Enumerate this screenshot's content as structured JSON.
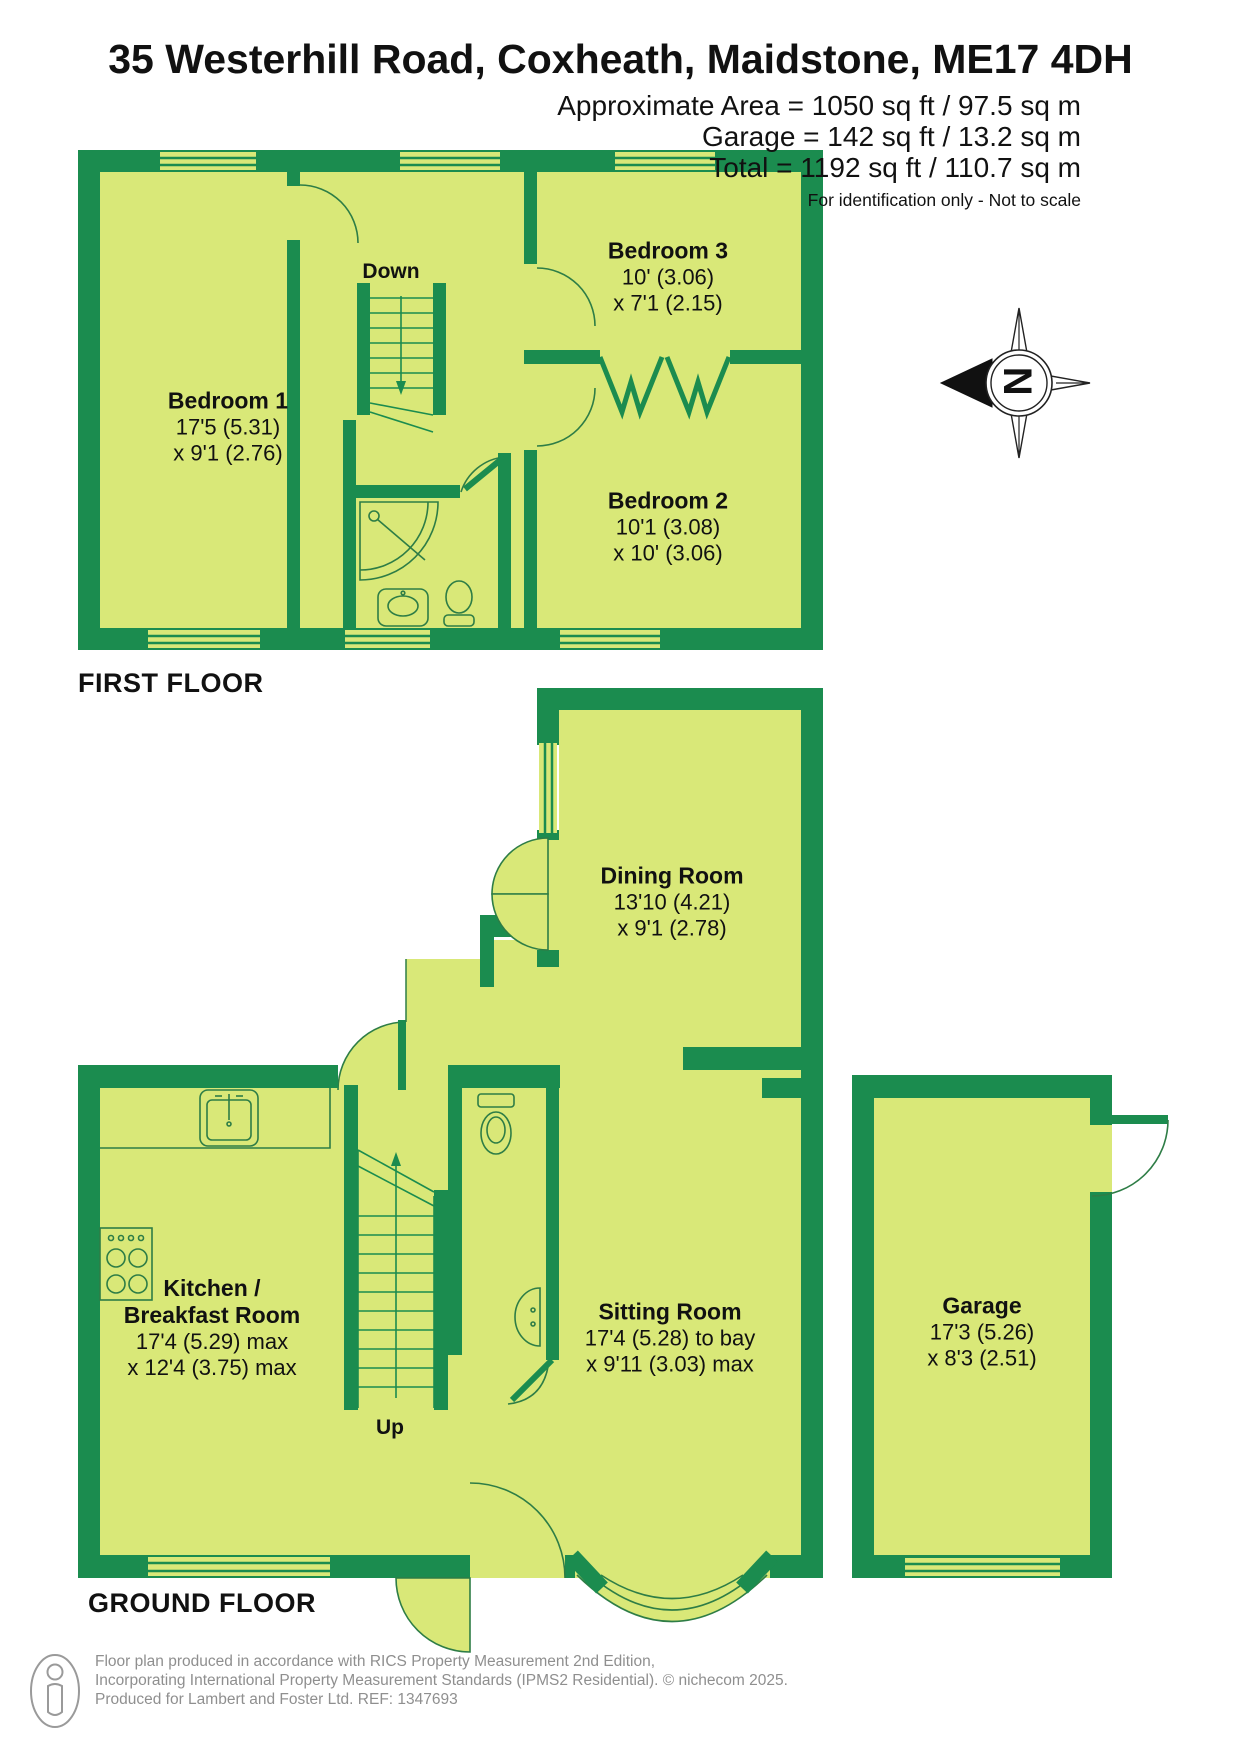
{
  "header": {
    "title": "35 Westerhill Road, Coxheath, Maidstone, ME17 4DH",
    "area_line1": "Approximate Area = 1050 sq ft / 97.5 sq m",
    "area_line2": "Garage = 142 sq ft / 13.2 sq m",
    "area_line3": "Total = 1192 sq ft / 110.7 sq m",
    "disclaimer": "For identification only - Not to scale"
  },
  "compass": {
    "north_label": "N"
  },
  "floors": {
    "first": {
      "label": "FIRST FLOOR",
      "stairs_label": "Down"
    },
    "ground": {
      "label": "GROUND FLOOR",
      "stairs_label": "Up"
    }
  },
  "rooms": {
    "bedroom1": {
      "name": "Bedroom 1",
      "dim1": "17'5 (5.31)",
      "dim2": "x 9'1 (2.76)"
    },
    "bedroom3": {
      "name": "Bedroom 3",
      "dim1": "10' (3.06)",
      "dim2": "x 7'1 (2.15)"
    },
    "bedroom2": {
      "name": "Bedroom 2",
      "dim1": "10'1 (3.08)",
      "dim2": "x 10' (3.06)"
    },
    "dining": {
      "name": "Dining Room",
      "dim1": "13'10 (4.21)",
      "dim2": "x 9'1 (2.78)"
    },
    "kitchen": {
      "name1": "Kitchen /",
      "name2": "Breakfast Room",
      "dim1": "17'4 (5.29) max",
      "dim2": "x 12'4 (3.75) max"
    },
    "sitting": {
      "name": "Sitting Room",
      "dim1": "17'4 (5.28) to bay",
      "dim2": "x 9'11 (3.03) max"
    },
    "garage": {
      "name": "Garage",
      "dim1": "17'3 (5.26)",
      "dim2": "x 8'3 (2.51)"
    }
  },
  "footer": {
    "line1": "Floor plan produced in accordance with RICS Property Measurement 2nd Edition,",
    "line2": "Incorporating International Property Measurement Standards (IPMS2 Residential).  © nichecom 2025.",
    "line3": "Produced for Lambert and Foster Ltd.   REF: 1347693"
  },
  "colors": {
    "wall_green": "#1b8c4f",
    "room_fill": "#d9e878",
    "line_green": "#2e7d46",
    "footer_grey": "#8f8f8f"
  }
}
